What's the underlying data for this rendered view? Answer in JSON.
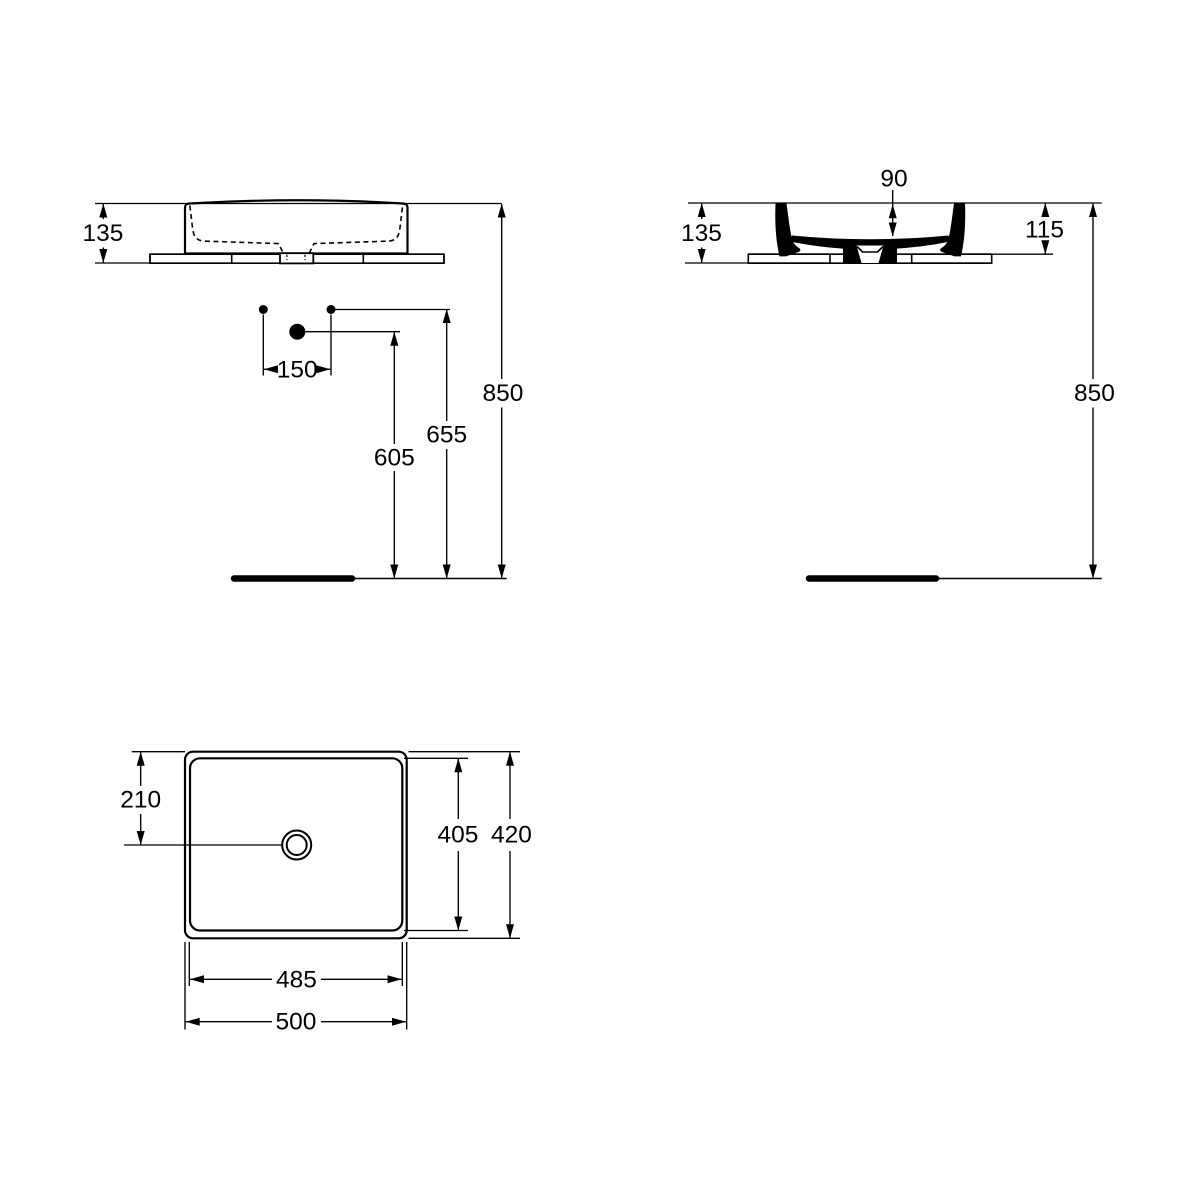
{
  "colors": {
    "line": "#000000",
    "background": "#ffffff"
  },
  "views": {
    "front": {
      "title": "front elevation of basin on counter",
      "dims": {
        "height": "135",
        "tap_hole_spacing": "150",
        "outlet_height": "605",
        "tap_hole_height": "655",
        "rim_height": "850"
      }
    },
    "side": {
      "title": "side section of basin on counter",
      "dims": {
        "bowl_depth": "90",
        "height": "135",
        "rim_above_counter": "115",
        "rim_height": "850"
      }
    },
    "plan": {
      "title": "plan view of basin",
      "dims": {
        "drain_offset": "210",
        "inner_depth": "405",
        "overall_depth": "420",
        "inner_width": "485",
        "overall_width": "500"
      }
    }
  }
}
